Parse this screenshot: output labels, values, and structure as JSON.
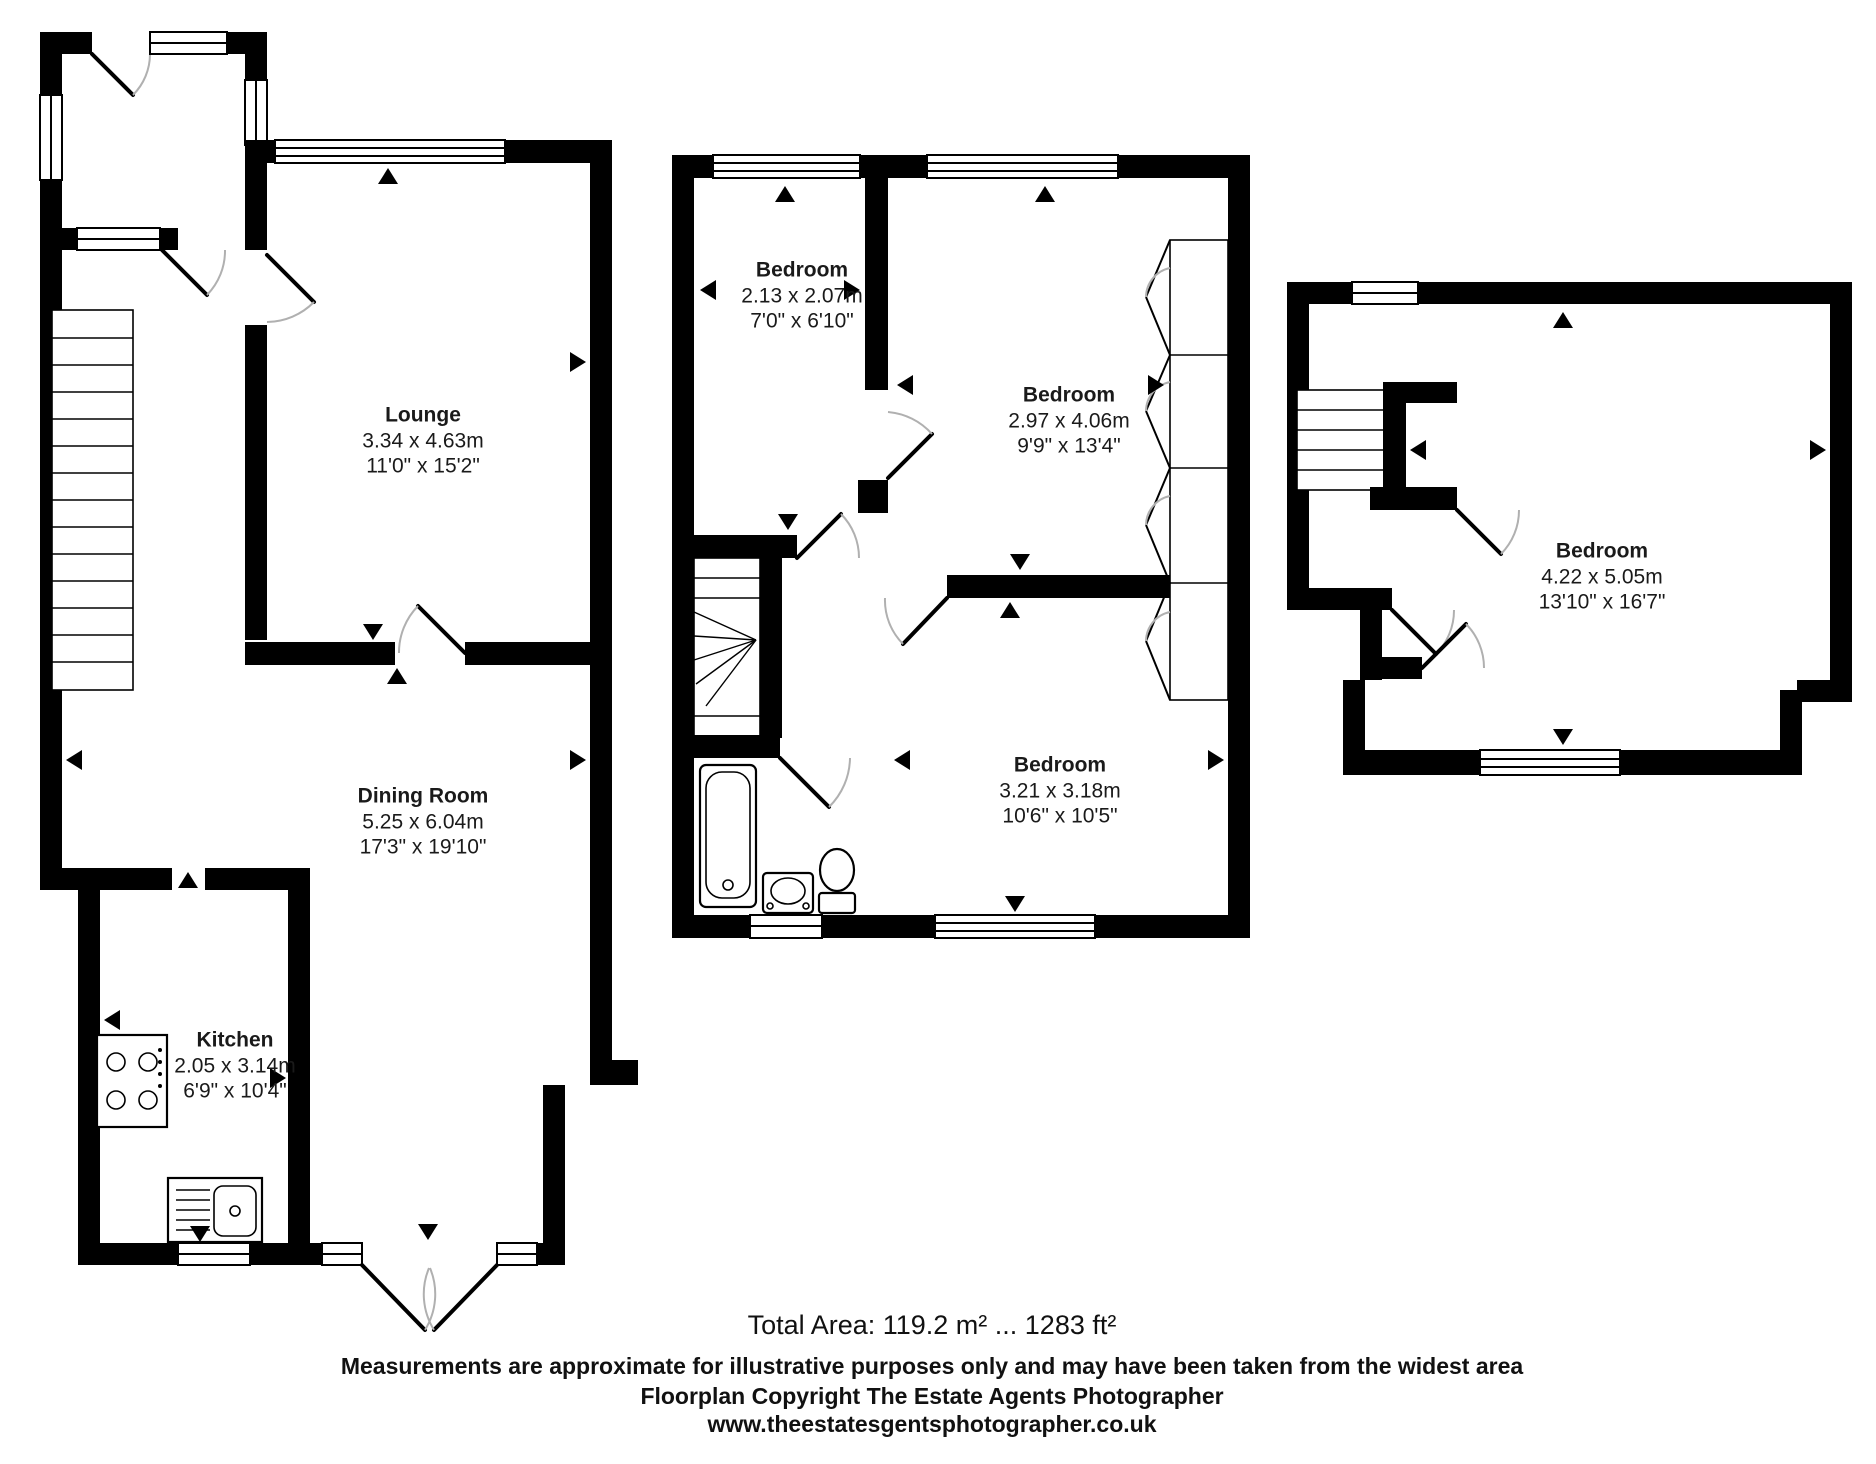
{
  "title": "Property Floorplan",
  "colors": {
    "wall": "#000000",
    "door_arc": "#b0b0b0",
    "background": "#ffffff",
    "text": "#1a1a1a"
  },
  "rooms": {
    "lounge": {
      "name": "Lounge",
      "metric": "3.34 x 4.63m",
      "imperial": "11'0\" x 15'2\""
    },
    "dining": {
      "name": "Dining Room",
      "metric": "5.25 x 6.04m",
      "imperial": "17'3\" x 19'10\""
    },
    "kitchen": {
      "name": "Kitchen",
      "metric": "2.05 x 3.14m",
      "imperial": "6'9\" x 10'4\""
    },
    "bed1": {
      "name": "Bedroom",
      "metric": "2.13 x 2.07m",
      "imperial": "7'0\" x 6'10\""
    },
    "bed2": {
      "name": "Bedroom",
      "metric": "2.97 x 4.06m",
      "imperial": "9'9\" x 13'4\""
    },
    "bed3": {
      "name": "Bedroom",
      "metric": "3.21 x 3.18m",
      "imperial": "10'6\" x 10'5\""
    },
    "bed4": {
      "name": "Bedroom",
      "metric": "4.22 x 5.05m",
      "imperial": "13'10\" x 16'7\""
    }
  },
  "footer": {
    "total_area": "Total Area: 119.2 m² ... 1283 ft²",
    "disclaimer": "Measurements are approximate for illustrative purposes only and may have been taken from the widest area",
    "copyright": "Floorplan Copyright The Estate Agents Photographer",
    "website": "www.theestatesgentsphotographer.co.uk"
  }
}
